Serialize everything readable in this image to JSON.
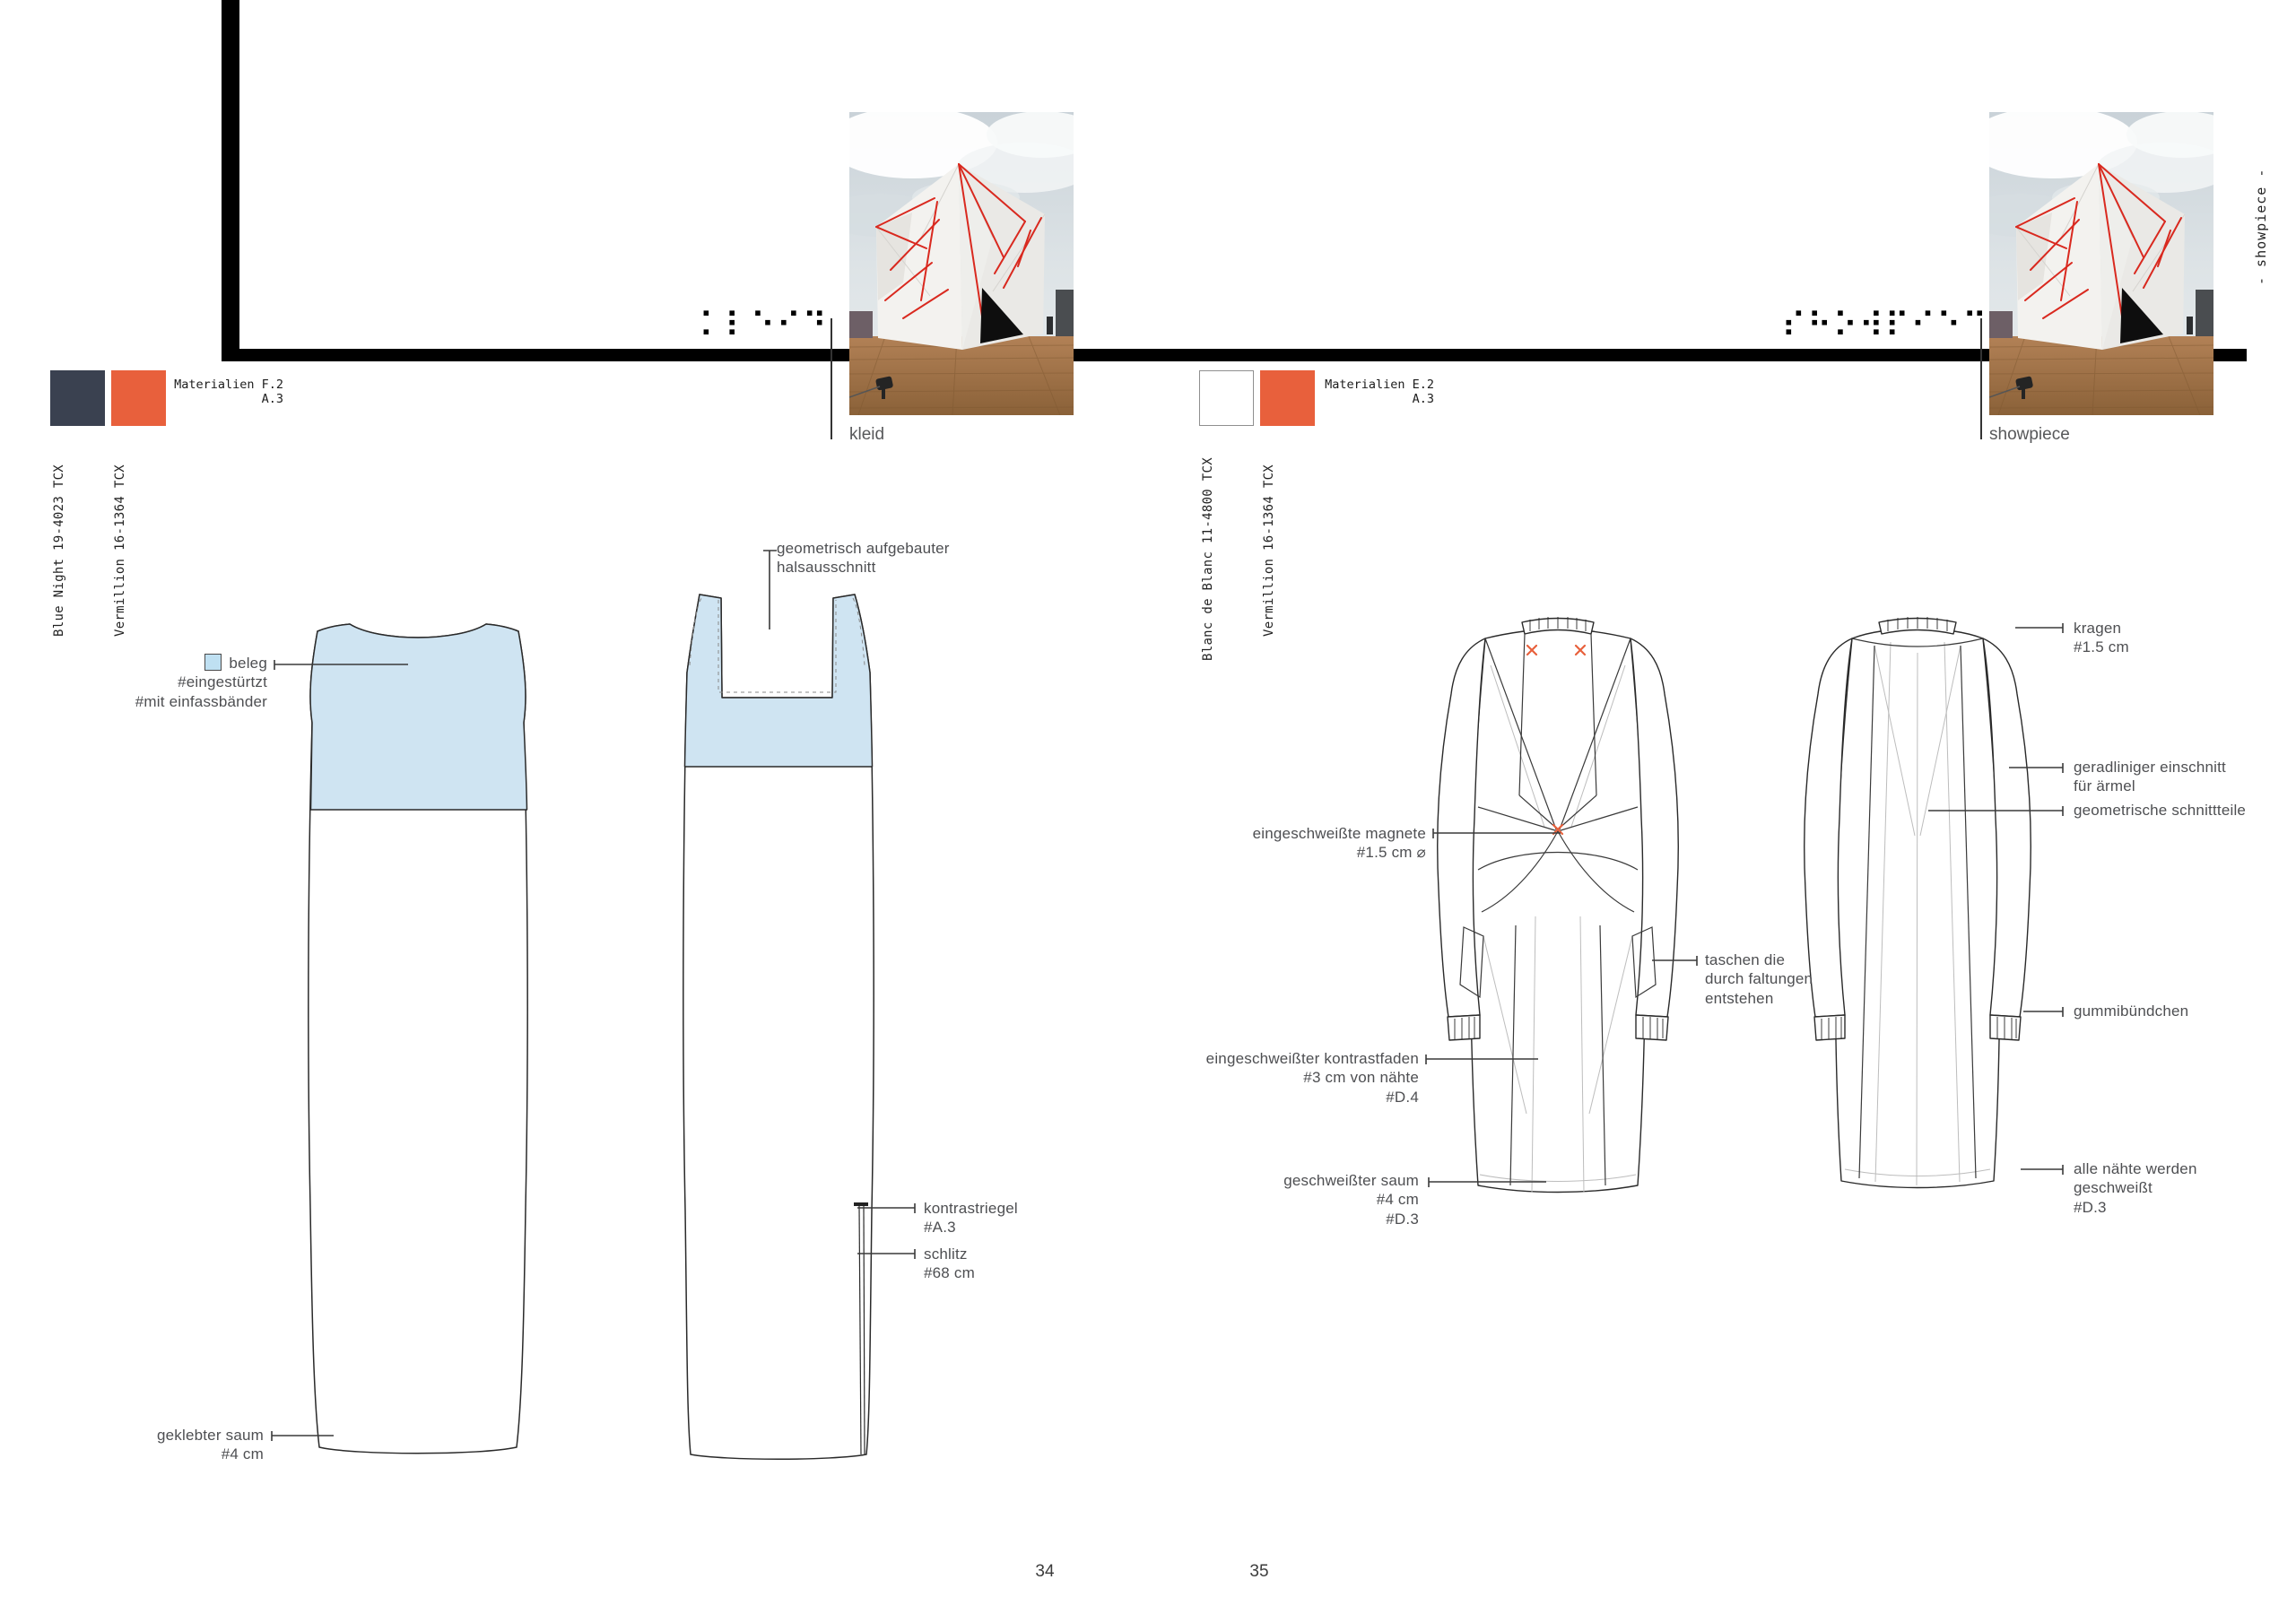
{
  "colors": {
    "blue_night": "#3a4150",
    "vermillion": "#e8603c",
    "blanc": "#ffffff",
    "beleg_blue": "#bfe0f2",
    "accent_red": "#d9291f"
  },
  "left_page": {
    "materials": {
      "line1": "Materialien F.2",
      "line2": "A.3"
    },
    "swatches": [
      {
        "name": "Blue Night 19-4023 TCX",
        "color": "#3a4150"
      },
      {
        "name": "Vermillion 16-1364 TCX",
        "color": "#e8603c"
      }
    ],
    "braille": "⠅⠇⠑⠊⠙",
    "photo_caption": "kleid",
    "annotations": {
      "halsausschnitt": {
        "lines": [
          "geometrisch aufgebauter",
          "halsausschnitt"
        ]
      },
      "beleg": {
        "label": "beleg",
        "swatch_color": "#bfe0f2",
        "lines": [
          "#eingestürtzt",
          "#mit einfassbänder"
        ]
      },
      "kontrastriegel": {
        "lines": [
          "kontrastriegel",
          "#A.3"
        ]
      },
      "schlitz": {
        "lines": [
          "schlitz",
          "#68 cm"
        ]
      },
      "saum": {
        "lines": [
          "geklebter saum",
          "#4 cm"
        ]
      }
    },
    "page_number": "34"
  },
  "right_page": {
    "materials": {
      "line1": "Materialien E.2",
      "line2": "A.3"
    },
    "swatches": [
      {
        "name": "Blanc de Blanc 11-4800 TCX",
        "color": "#ffffff"
      },
      {
        "name": "Vermillion 16-1364 TCX",
        "color": "#e8603c"
      }
    ],
    "braille": "⠎⠓⠕⠺⠏⠊⠑⠉⠑",
    "photo_caption": "showpiece",
    "side_label": "- showpiece -",
    "annotations": {
      "kragen": {
        "lines": [
          "kragen",
          "#1.5 cm"
        ]
      },
      "einschnitt": {
        "lines": [
          "geradliniger einschnitt",
          "für ärmel"
        ]
      },
      "schnittteile": {
        "lines": [
          "geometrische schnittteile"
        ]
      },
      "magnete": {
        "lines": [
          "eingeschweißte magnete",
          "#1.5 cm ⌀"
        ]
      },
      "taschen": {
        "lines": [
          "taschen die",
          "durch faltungen",
          "entstehen"
        ]
      },
      "gummibuendchen": {
        "lines": [
          "gummibündchen"
        ]
      },
      "kontrastfaden": {
        "lines": [
          "eingeschweißter kontrastfaden",
          "#3 cm von nähte",
          "#D.4"
        ]
      },
      "saum": {
        "lines": [
          "geschweißter saum",
          "#4 cm",
          "#D.3"
        ]
      },
      "naehte": {
        "lines": [
          "alle nähte werden",
          "geschweißt",
          "#D.3"
        ]
      }
    },
    "page_number": "35"
  }
}
